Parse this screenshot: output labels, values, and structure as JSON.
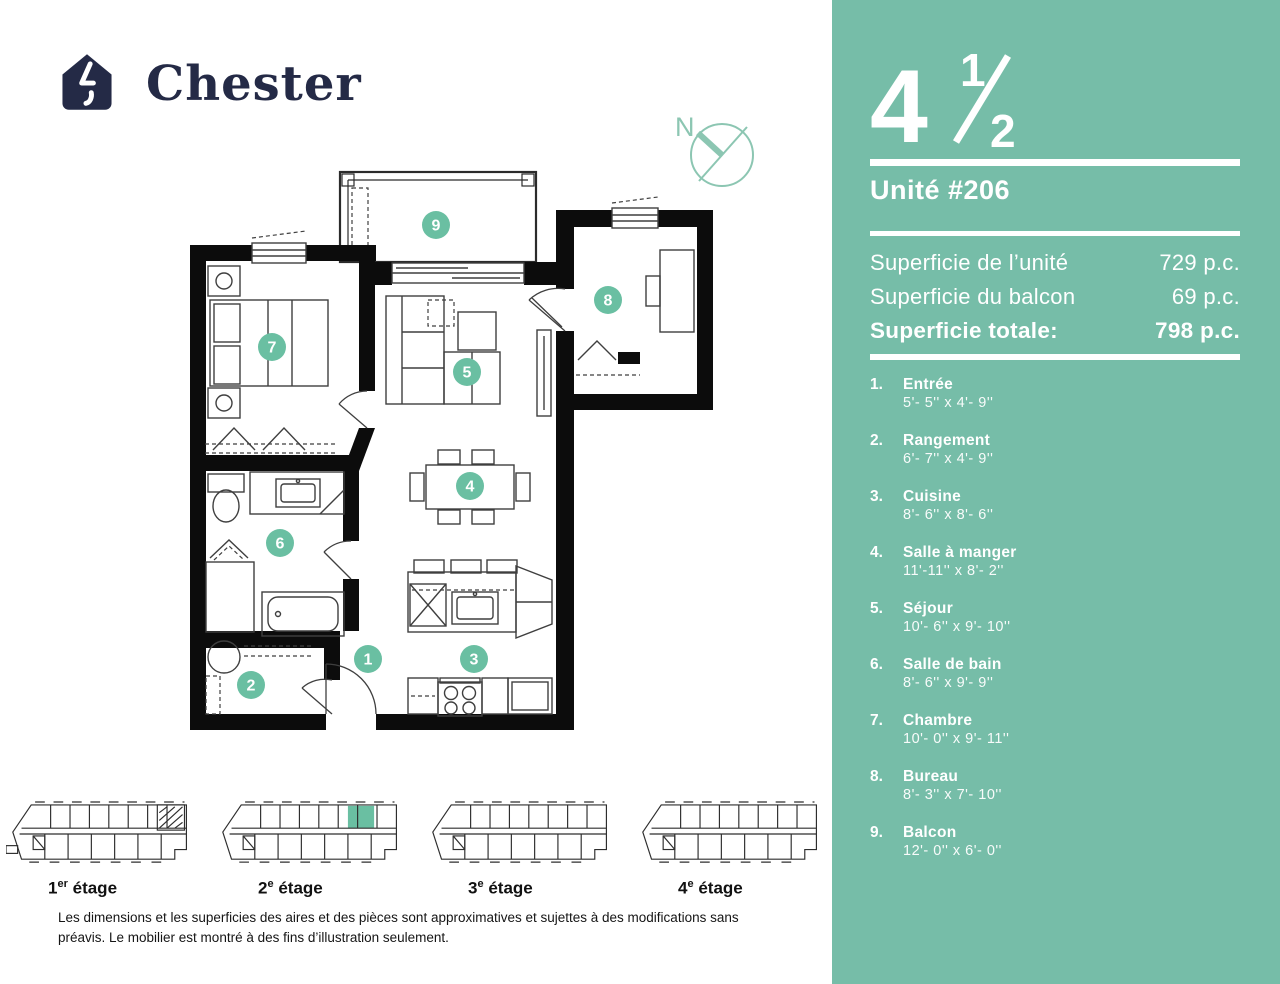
{
  "brand": {
    "name": "Chester"
  },
  "compass": {
    "label": "N"
  },
  "unit": {
    "type_whole": "4",
    "frac_num": "1",
    "frac_den": "2",
    "label": "Unité #206"
  },
  "areas": [
    {
      "label": "Superficie de l’unité",
      "value": "729 p.c."
    },
    {
      "label": "Superficie du balcon",
      "value": "69 p.c."
    },
    {
      "label": "Superficie totale:",
      "value": "798 p.c."
    }
  ],
  "rooms": [
    {
      "num": "1",
      "list_num": "1.",
      "name": "Entrée",
      "dims": "5'- 5'' x 4'- 9''"
    },
    {
      "num": "2",
      "list_num": "2.",
      "name": "Rangement",
      "dims": "6'- 7'' x  4'- 9''"
    },
    {
      "num": "3",
      "list_num": "3.",
      "name": "Cuisine",
      "dims": "8'- 6'' x  8'- 6''"
    },
    {
      "num": "4",
      "list_num": "4.",
      "name": "Salle à manger",
      "dims": "11'-11'' x  8'- 2''"
    },
    {
      "num": "5",
      "list_num": "5.",
      "name": "Séjour",
      "dims": "10'- 6'' x  9'- 10''"
    },
    {
      "num": "6",
      "list_num": "6.",
      "name": "Salle de bain",
      "dims": "8'- 6'' x  9'- 9''"
    },
    {
      "num": "7",
      "list_num": "7.",
      "name": "Chambre",
      "dims": "10'- 0'' x  9'- 11''"
    },
    {
      "num": "8",
      "list_num": "8.",
      "name": "Bureau",
      "dims": "8'- 3'' x  7'- 10''"
    },
    {
      "num": "9",
      "list_num": "9.",
      "name": "Balcon",
      "dims": "12'- 0'' x 6'- 0''"
    }
  ],
  "floors": [
    {
      "num": "1",
      "sup": "er",
      "word": "étage"
    },
    {
      "num": "2",
      "sup": "e",
      "word": "étage"
    },
    {
      "num": "3",
      "sup": "e",
      "word": "étage"
    },
    {
      "num": "4",
      "sup": "e",
      "word": "étage"
    }
  ],
  "disclaimer": "Les dimensions et les superficies des aires et des pièces sont approximatives et sujettes à des modifications sans préavis. Le mobilier est montré à des fins d’illustration seulement.",
  "colors": {
    "panel": "#76BDA8",
    "accent": "#6ABFA2",
    "navy": "#242A46",
    "compass": "#8CC6B2"
  }
}
